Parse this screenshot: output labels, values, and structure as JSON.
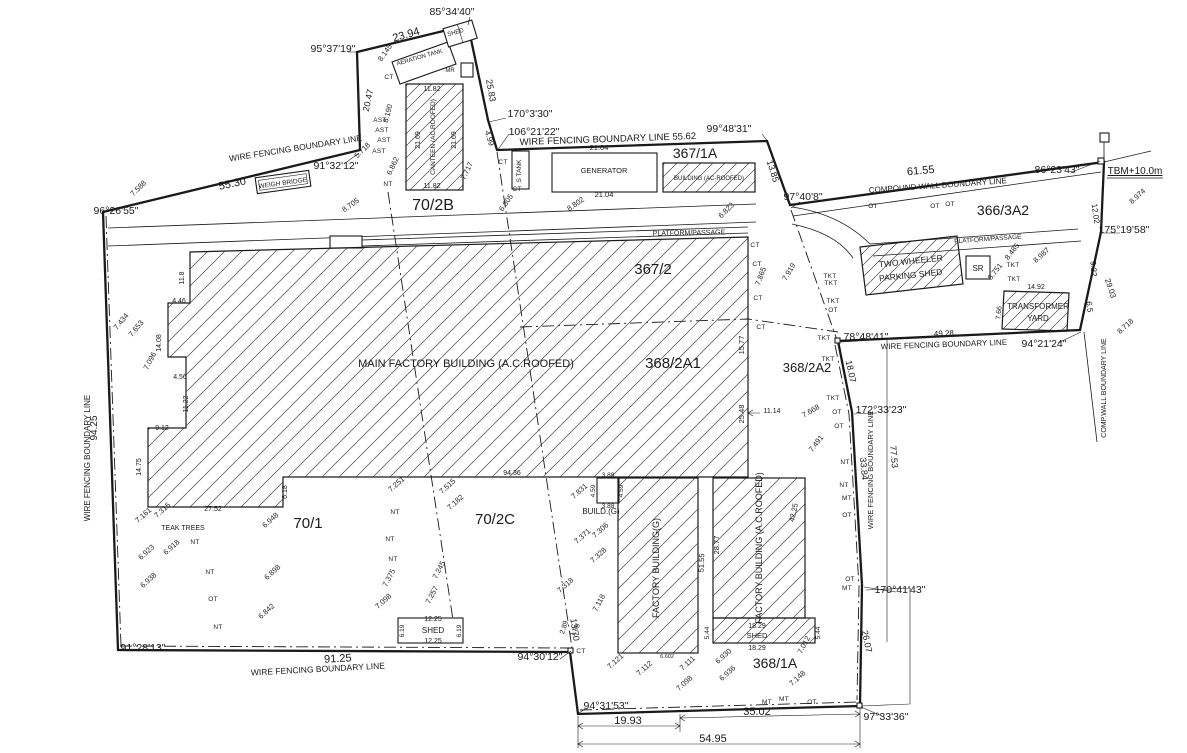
{
  "colors": {
    "ink": "#1a1a1a",
    "background": "#ffffff"
  },
  "plot_labels": [
    {
      "t": "70/2B",
      "x": 433,
      "y": 210,
      "s": 16
    },
    {
      "t": "367/1A",
      "x": 695,
      "y": 158,
      "s": 14
    },
    {
      "t": "366/3A2",
      "x": 1003,
      "y": 215,
      "s": 14
    },
    {
      "t": "367/2",
      "x": 653,
      "y": 274,
      "s": 15
    },
    {
      "t": "368/2A1",
      "x": 673,
      "y": 368,
      "s": 15
    },
    {
      "t": "368/2A2",
      "x": 807,
      "y": 372,
      "s": 13
    },
    {
      "t": "70/1",
      "x": 308,
      "y": 528,
      "s": 15
    },
    {
      "t": "70/2C",
      "x": 495,
      "y": 524,
      "s": 15
    },
    {
      "t": "368/1A",
      "x": 775,
      "y": 668,
      "s": 14
    }
  ],
  "area_labels": [
    {
      "t": "WIRE FENCING BOUNDARY LINE",
      "x": 296,
      "y": 151,
      "r": -9,
      "s": 8.5
    },
    {
      "t": "WIRE FENCING BOUNDARY LINE 55.62",
      "x": 608,
      "y": 142,
      "r": -2,
      "s": 9.5
    },
    {
      "t": "COMPOUND WALL BOUNDARY LINE",
      "x": 938,
      "y": 188,
      "r": -4,
      "s": 8
    },
    {
      "t": "WIRE FENCING BOUNDARY LINE",
      "x": 944,
      "y": 347,
      "r": -2,
      "s": 8
    },
    {
      "t": "WIRE FENCING BOUNDARY LINE",
      "x": 90,
      "y": 458,
      "r": -90,
      "s": 8
    },
    {
      "t": "WIRE FENCING BOUNDARY LINE",
      "x": 873,
      "y": 470,
      "r": -90,
      "s": 7.5
    },
    {
      "t": "COMP.WALL BOUNDARY LINE",
      "x": 1106,
      "y": 388,
      "r": -90,
      "s": 7
    },
    {
      "t": "WIRE FENCING BOUNDARY LINE",
      "x": 318,
      "y": 672,
      "r": -3,
      "s": 8.5
    },
    {
      "t": "PLATFORM/PASSAGE",
      "x": 689,
      "y": 235,
      "r": -1,
      "s": 7
    },
    {
      "t": "PLATFORM/PASSAGE",
      "x": 988,
      "y": 241,
      "r": -4,
      "s": 6.5
    },
    {
      "t": "WEIGH BRIDGE",
      "x": 283,
      "y": 185,
      "r": -8,
      "s": 6.5
    },
    {
      "t": "TEAK TREES",
      "x": 183,
      "y": 530,
      "s": 7
    },
    {
      "t": "AERATION TANK",
      "x": 420,
      "y": 59,
      "r": -16,
      "s": 6
    },
    {
      "t": "SHED",
      "x": 456,
      "y": 34,
      "r": -16,
      "s": 6
    },
    {
      "t": "MR",
      "x": 450,
      "y": 72,
      "s": 6
    },
    {
      "t": "S TANK",
      "x": 521,
      "y": 171,
      "r": -90,
      "s": 6.5
    },
    {
      "t": "GENERATOR",
      "x": 604,
      "y": 173,
      "s": 7.5
    },
    {
      "t": "BUILDING (AC-ROOFED)",
      "x": 709,
      "y": 180,
      "s": 6
    },
    {
      "t": "CANTEEN (AC.ROOFED)",
      "x": 435,
      "y": 137,
      "r": -90,
      "s": 6.5
    },
    {
      "t": "MAIN FACTORY BUILDING (A.C.ROOFED)",
      "x": 466,
      "y": 367,
      "s": 11
    },
    {
      "t": "BUILD.(G)",
      "x": 601,
      "y": 514,
      "s": 8
    },
    {
      "t": "FACTORY BUILDING(G)",
      "x": 659,
      "y": 568,
      "r": -90,
      "s": 9
    },
    {
      "t": "FACTORY BUILDING (A.C.ROOFED)",
      "x": 762,
      "y": 548,
      "r": -90,
      "s": 9
    },
    {
      "t": "SHED",
      "x": 433,
      "y": 633,
      "s": 8
    },
    {
      "t": "SHED",
      "x": 757,
      "y": 638,
      "s": 7.5
    },
    {
      "t": "TWO WHEELER",
      "x": 911,
      "y": 264,
      "r": -6,
      "s": 8.5
    },
    {
      "t": "PARKING SHED",
      "x": 911,
      "y": 278,
      "r": -6,
      "s": 8.5
    },
    {
      "t": "TRANSFORMER",
      "x": 1038,
      "y": 309,
      "s": 8
    },
    {
      "t": "YARD",
      "x": 1038,
      "y": 321,
      "s": 8
    },
    {
      "t": "SR",
      "x": 978,
      "y": 271,
      "s": 8
    },
    {
      "t": "TBM+10.0m",
      "x": 1135,
      "y": 174,
      "s": 10,
      "u": true
    }
  ],
  "angle_labels": [
    {
      "t": "85°34'40\"",
      "x": 452,
      "y": 15
    },
    {
      "t": "95°37'19\"",
      "x": 333,
      "y": 52
    },
    {
      "t": "91°32'12\"",
      "x": 336,
      "y": 169
    },
    {
      "t": "96°26'55\"",
      "x": 116,
      "y": 214
    },
    {
      "t": "170°3'30\"",
      "x": 530,
      "y": 117
    },
    {
      "t": "106°21'22\"",
      "x": 534,
      "y": 135
    },
    {
      "t": "99°48'31\"",
      "x": 729,
      "y": 132
    },
    {
      "t": "97°40'8\"",
      "x": 803,
      "y": 200
    },
    {
      "t": "86°23'43\"",
      "x": 1057,
      "y": 173
    },
    {
      "t": "175°19'58\"",
      "x": 1124,
      "y": 233
    },
    {
      "t": "94°21'24\"",
      "x": 1044,
      "y": 347
    },
    {
      "t": "78°48'41\"",
      "x": 866,
      "y": 340
    },
    {
      "t": "172°33'23\"",
      "x": 881,
      "y": 413
    },
    {
      "t": "170°41'43\"",
      "x": 900,
      "y": 593
    },
    {
      "t": "97°33'36\"",
      "x": 886,
      "y": 720
    },
    {
      "t": "94°31'53\"",
      "x": 606,
      "y": 709
    },
    {
      "t": "94°30'12\"",
      "x": 540,
      "y": 660
    },
    {
      "t": "91°28'13\"",
      "x": 143,
      "y": 651
    }
  ],
  "dimension_labels": [
    {
      "t": "55.30",
      "x": 233,
      "y": 187,
      "r": -12,
      "s": 11
    },
    {
      "t": "23.94",
      "x": 407,
      "y": 38,
      "r": -16,
      "s": 11
    },
    {
      "t": "20.47",
      "x": 371,
      "y": 101,
      "r": -78,
      "s": 9
    },
    {
      "t": "25.83",
      "x": 488,
      "y": 91,
      "r": 80,
      "s": 9
    },
    {
      "t": "4.99",
      "x": 487,
      "y": 139,
      "r": 72,
      "s": 8
    },
    {
      "t": "13.85",
      "x": 770,
      "y": 172,
      "r": 72,
      "s": 9
    },
    {
      "t": "21.04",
      "x": 599,
      "y": 150,
      "s": 7.5
    },
    {
      "t": "21.04",
      "x": 604,
      "y": 197,
      "s": 7.5
    },
    {
      "t": "61.55",
      "x": 921,
      "y": 174,
      "r": -5,
      "s": 11
    },
    {
      "t": "94.25",
      "x": 97,
      "y": 428,
      "r": -90,
      "s": 10
    },
    {
      "t": "91.25",
      "x": 338,
      "y": 662,
      "r": -3,
      "s": 11
    },
    {
      "t": "19.93",
      "x": 628,
      "y": 724,
      "s": 11
    },
    {
      "t": "35.02",
      "x": 757,
      "y": 715,
      "s": 11
    },
    {
      "t": "54.95",
      "x": 713,
      "y": 742,
      "s": 11
    },
    {
      "t": "26.07",
      "x": 864,
      "y": 642,
      "r": 78,
      "s": 9
    },
    {
      "t": "13.70",
      "x": 572,
      "y": 630,
      "r": 82,
      "s": 9
    },
    {
      "t": "18.07",
      "x": 848,
      "y": 372,
      "r": 78,
      "s": 9
    },
    {
      "t": "33.84",
      "x": 861,
      "y": 469,
      "r": 85,
      "s": 9
    },
    {
      "t": "77.53",
      "x": 891,
      "y": 457,
      "r": 85,
      "s": 9
    },
    {
      "t": "49.28",
      "x": 944,
      "y": 336,
      "r": -3,
      "s": 8
    },
    {
      "t": "12.02",
      "x": 1093,
      "y": 214,
      "r": 82,
      "s": 8
    },
    {
      "t": "29.03",
      "x": 1108,
      "y": 289,
      "r": 72,
      "s": 8
    },
    {
      "t": "9.22",
      "x": 1091,
      "y": 269,
      "r": 85,
      "s": 8
    },
    {
      "t": "6.5",
      "x": 1087,
      "y": 307,
      "r": 85,
      "s": 8
    },
    {
      "t": "94.36",
      "x": 512,
      "y": 475,
      "s": 7
    },
    {
      "t": "25.48",
      "x": 744,
      "y": 414,
      "r": -90,
      "s": 7.5
    },
    {
      "t": "15.77",
      "x": 744,
      "y": 345,
      "r": -90,
      "s": 7.5
    },
    {
      "t": "11.82",
      "x": 432,
      "y": 91,
      "s": 7
    },
    {
      "t": "11.82",
      "x": 432,
      "y": 188,
      "s": 7
    },
    {
      "t": "21.69",
      "x": 420,
      "y": 140,
      "r": -90,
      "s": 7
    },
    {
      "t": "21.69",
      "x": 456,
      "y": 140,
      "r": -90,
      "s": 7
    },
    {
      "t": "11.14",
      "x": 772,
      "y": 413,
      "s": 7
    },
    {
      "t": "3.88",
      "x": 608,
      "y": 477,
      "s": 6.5
    },
    {
      "t": "3.88",
      "x": 608,
      "y": 508,
      "s": 6.5
    },
    {
      "t": "4.59",
      "x": 595,
      "y": 491,
      "r": -90,
      "s": 6.5
    },
    {
      "t": "4.59",
      "x": 623,
      "y": 491,
      "r": -90,
      "s": 6.5
    },
    {
      "t": "12.25",
      "x": 433,
      "y": 621,
      "s": 7
    },
    {
      "t": "12.25",
      "x": 433,
      "y": 643,
      "s": 7
    },
    {
      "t": "6.19",
      "x": 404,
      "y": 631,
      "r": -90,
      "s": 6.5
    },
    {
      "t": "6.19",
      "x": 461,
      "y": 631,
      "r": -90,
      "s": 6.5
    },
    {
      "t": "18.29",
      "x": 757,
      "y": 628,
      "s": 7
    },
    {
      "t": "18.29",
      "x": 757,
      "y": 650,
      "s": 7
    },
    {
      "t": "5.44",
      "x": 709,
      "y": 633,
      "r": -90,
      "s": 6.5
    },
    {
      "t": "5.44",
      "x": 820,
      "y": 633,
      "r": -90,
      "s": 6.5
    },
    {
      "t": "28.77",
      "x": 719,
      "y": 545,
      "r": -90,
      "s": 7.5
    },
    {
      "t": "42.25",
      "x": 796,
      "y": 513,
      "r": -78,
      "s": 7.5
    },
    {
      "t": "51.55",
      "x": 704,
      "y": 563,
      "r": -88,
      "s": 7.5
    },
    {
      "t": "14.92",
      "x": 1036,
      "y": 289,
      "s": 7
    },
    {
      "t": "7.66",
      "x": 1001,
      "y": 313,
      "r": -85,
      "s": 7
    },
    {
      "t": "4.46",
      "x": 179,
      "y": 303,
      "s": 7
    },
    {
      "t": "14.08",
      "x": 161,
      "y": 343,
      "r": -90,
      "s": 7
    },
    {
      "t": "4.56",
      "x": 180,
      "y": 379,
      "s": 7
    },
    {
      "t": "11.22",
      "x": 188,
      "y": 404,
      "r": -90,
      "s": 7
    },
    {
      "t": "11.8",
      "x": 184,
      "y": 278,
      "r": -90,
      "s": 7
    },
    {
      "t": "9.12",
      "x": 162,
      "y": 430,
      "s": 7
    },
    {
      "t": "6.18",
      "x": 287,
      "y": 492,
      "r": -90,
      "s": 7
    },
    {
      "t": "27.52",
      "x": 213,
      "y": 511,
      "s": 7
    },
    {
      "t": "14.75",
      "x": 141,
      "y": 467,
      "r": -90,
      "s": 7
    },
    {
      "t": "1.85",
      "x": 577,
      "y": 631,
      "r": -62,
      "s": 7
    },
    {
      "t": "2.89",
      "x": 566,
      "y": 628,
      "r": -72,
      "s": 7
    }
  ],
  "spot_levels": [
    {
      "t": "8.145",
      "x": 387,
      "y": 54,
      "r": -55
    },
    {
      "t": "8.190",
      "x": 390,
      "y": 114,
      "r": -75
    },
    {
      "t": "6.862",
      "x": 395,
      "y": 167,
      "r": -65
    },
    {
      "t": "5.718",
      "x": 364,
      "y": 152,
      "r": -45
    },
    {
      "t": "8.705",
      "x": 352,
      "y": 207,
      "r": -35
    },
    {
      "t": "7.717",
      "x": 469,
      "y": 172,
      "r": -65
    },
    {
      "t": "7.588",
      "x": 140,
      "y": 190,
      "r": -45
    },
    {
      "t": "6.805",
      "x": 508,
      "y": 204,
      "r": -55
    },
    {
      "t": "8.802",
      "x": 577,
      "y": 206,
      "r": -35
    },
    {
      "t": "6.823",
      "x": 728,
      "y": 212,
      "r": -45
    },
    {
      "t": "7.865",
      "x": 763,
      "y": 277,
      "r": -70
    },
    {
      "t": "7.919",
      "x": 791,
      "y": 273,
      "r": -60
    },
    {
      "t": "7.434",
      "x": 123,
      "y": 323,
      "r": -50
    },
    {
      "t": "7.653",
      "x": 138,
      "y": 330,
      "r": -50
    },
    {
      "t": "7.096",
      "x": 152,
      "y": 362,
      "r": -62
    },
    {
      "t": "7.161",
      "x": 145,
      "y": 517,
      "r": -42
    },
    {
      "t": "7.315",
      "x": 164,
      "y": 512,
      "r": -42
    },
    {
      "t": "6.923",
      "x": 148,
      "y": 554,
      "r": -42
    },
    {
      "t": "6.938",
      "x": 150,
      "y": 582,
      "r": -42
    },
    {
      "t": "6.918",
      "x": 173,
      "y": 549,
      "r": -42
    },
    {
      "t": "6.948",
      "x": 272,
      "y": 522,
      "r": -42
    },
    {
      "t": "6.898",
      "x": 274,
      "y": 574,
      "r": -42
    },
    {
      "t": "6.842",
      "x": 268,
      "y": 613,
      "r": -42
    },
    {
      "t": "7.251",
      "x": 398,
      "y": 486,
      "r": -42
    },
    {
      "t": "7.515",
      "x": 449,
      "y": 488,
      "r": -42
    },
    {
      "t": "7.182",
      "x": 457,
      "y": 504,
      "r": -42
    },
    {
      "t": "7.245",
      "x": 441,
      "y": 571,
      "r": -62
    },
    {
      "t": "7.257",
      "x": 434,
      "y": 596,
      "r": -62
    },
    {
      "t": "7.375",
      "x": 391,
      "y": 579,
      "r": -62
    },
    {
      "t": "7.098",
      "x": 385,
      "y": 603,
      "r": -42
    },
    {
      "t": "7.831",
      "x": 581,
      "y": 493,
      "r": -42
    },
    {
      "t": "7.371",
      "x": 584,
      "y": 538,
      "r": -42
    },
    {
      "t": "7.306",
      "x": 602,
      "y": 532,
      "r": -42
    },
    {
      "t": "7.328",
      "x": 600,
      "y": 557,
      "r": -42
    },
    {
      "t": "7.318",
      "x": 567,
      "y": 587,
      "r": -42
    },
    {
      "t": "7.118",
      "x": 601,
      "y": 604,
      "r": -62
    },
    {
      "t": "7.121",
      "x": 617,
      "y": 663,
      "r": -42
    },
    {
      "t": "7.112",
      "x": 646,
      "y": 670,
      "r": -42
    },
    {
      "t": "6.602",
      "x": 667,
      "y": 658,
      "s": 5.5
    },
    {
      "t": "7.111",
      "x": 689,
      "y": 665,
      "r": -42
    },
    {
      "t": "7.098",
      "x": 686,
      "y": 685,
      "r": -42
    },
    {
      "t": "6.930",
      "x": 725,
      "y": 658,
      "r": -42
    },
    {
      "t": "6.936",
      "x": 729,
      "y": 675,
      "r": -42
    },
    {
      "t": "7.148",
      "x": 799,
      "y": 680,
      "r": -42
    },
    {
      "t": "7.012",
      "x": 806,
      "y": 646,
      "r": -62
    },
    {
      "t": "7.491",
      "x": 818,
      "y": 445,
      "r": -52
    },
    {
      "t": "7.668",
      "x": 812,
      "y": 413,
      "r": -30
    },
    {
      "t": "8.751",
      "x": 997,
      "y": 273,
      "r": -52
    },
    {
      "t": "8.485",
      "x": 1014,
      "y": 253,
      "r": -52
    },
    {
      "t": "8.987",
      "x": 1043,
      "y": 257,
      "r": -42
    },
    {
      "t": "8.974",
      "x": 1139,
      "y": 198,
      "r": -42
    },
    {
      "t": "8.718",
      "x": 1127,
      "y": 328,
      "r": -42
    }
  ],
  "survey_markers": [
    {
      "t": "AST",
      "x": 380,
      "y": 122
    },
    {
      "t": "AST",
      "x": 382,
      "y": 132
    },
    {
      "t": "AST",
      "x": 384,
      "y": 142
    },
    {
      "t": "AST",
      "x": 379,
      "y": 153
    },
    {
      "t": "NT",
      "x": 388,
      "y": 186
    },
    {
      "t": "CT",
      "x": 389,
      "y": 79
    },
    {
      "t": "CT",
      "x": 503,
      "y": 164
    },
    {
      "t": "CT",
      "x": 517,
      "y": 191
    },
    {
      "t": "CT",
      "x": 755,
      "y": 247
    },
    {
      "t": "CT",
      "x": 757,
      "y": 266
    },
    {
      "t": "CT",
      "x": 758,
      "y": 300
    },
    {
      "t": "CT",
      "x": 761,
      "y": 329
    },
    {
      "t": "CT",
      "x": 581,
      "y": 653
    },
    {
      "t": "NT",
      "x": 195,
      "y": 544
    },
    {
      "t": "NT",
      "x": 210,
      "y": 574
    },
    {
      "t": "NT",
      "x": 218,
      "y": 629
    },
    {
      "t": "NT",
      "x": 395,
      "y": 514
    },
    {
      "t": "NT",
      "x": 390,
      "y": 541
    },
    {
      "t": "NT",
      "x": 393,
      "y": 561
    },
    {
      "t": "OT",
      "x": 213,
      "y": 601
    },
    {
      "t": "OT",
      "x": 873,
      "y": 208
    },
    {
      "t": "OT",
      "x": 935,
      "y": 208
    },
    {
      "t": "OT",
      "x": 950,
      "y": 206
    },
    {
      "t": "TKT",
      "x": 830,
      "y": 278
    },
    {
      "t": "TKT",
      "x": 831,
      "y": 285
    },
    {
      "t": "TKT",
      "x": 833,
      "y": 303
    },
    {
      "t": "OT",
      "x": 833,
      "y": 312
    },
    {
      "t": "TKT",
      "x": 824,
      "y": 340
    },
    {
      "t": "TKT",
      "x": 828,
      "y": 361
    },
    {
      "t": "TKT",
      "x": 833,
      "y": 400
    },
    {
      "t": "OT",
      "x": 837,
      "y": 414
    },
    {
      "t": "OT",
      "x": 839,
      "y": 428
    },
    {
      "t": "NT",
      "x": 845,
      "y": 464
    },
    {
      "t": "NT",
      "x": 844,
      "y": 487
    },
    {
      "t": "MT",
      "x": 847,
      "y": 500
    },
    {
      "t": "OT",
      "x": 847,
      "y": 517
    },
    {
      "t": "OT",
      "x": 850,
      "y": 581
    },
    {
      "t": "MT",
      "x": 847,
      "y": 590
    },
    {
      "t": "MT",
      "x": 767,
      "y": 704
    },
    {
      "t": "MT",
      "x": 784,
      "y": 701
    },
    {
      "t": "OT",
      "x": 812,
      "y": 704
    },
    {
      "t": "TKT",
      "x": 1013,
      "y": 267
    },
    {
      "t": "TKT",
      "x": 1014,
      "y": 281
    }
  ]
}
